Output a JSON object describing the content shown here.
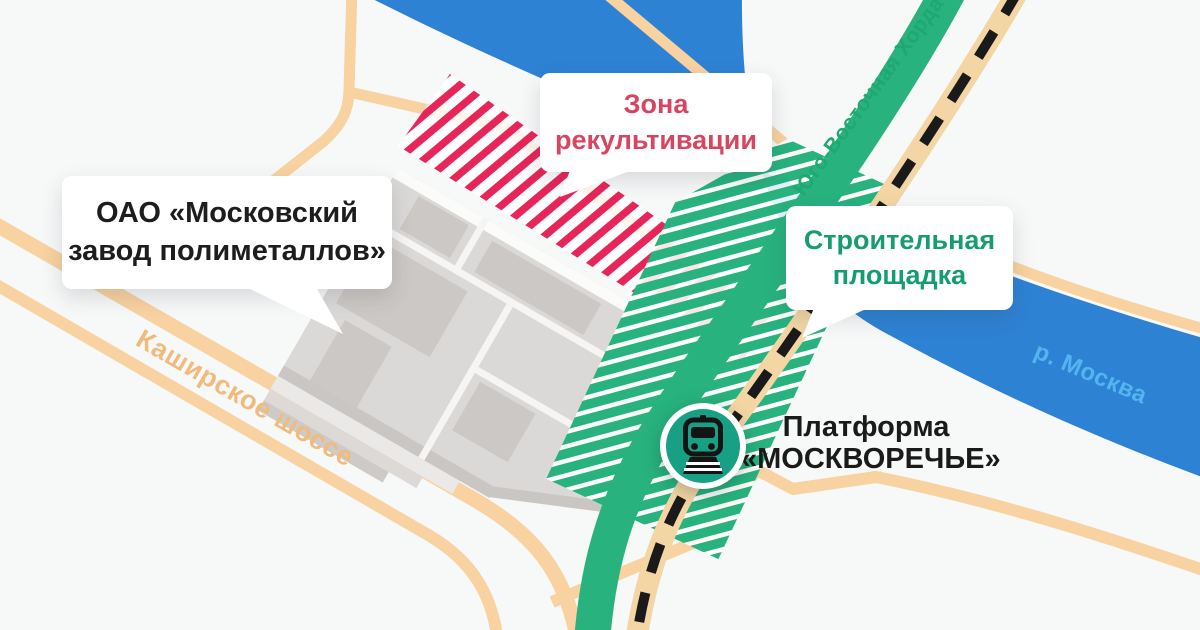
{
  "map": {
    "callouts": {
      "factory": {
        "line1": "ОАО «Московский",
        "line2": "завод полиметаллов»"
      },
      "recultivation_zone": {
        "line1": "Зона",
        "line2": "рекультивации"
      },
      "construction_site": {
        "line1": "Строительная",
        "line2": "площадка"
      }
    },
    "station": {
      "line1": "Платформа",
      "line2": "«МОСКВОРЕЧЬЕ»",
      "icon": "train-icon"
    },
    "roads": {
      "kashirskoye": "Каширское шоссе",
      "chord": "Юго-Восточная Хорда",
      "river": "р. Москва"
    },
    "colors": {
      "background": "#f7f8f8",
      "river": "#2e82d4",
      "river_label": "#53b4ee",
      "road_orange": "#f8d2a0",
      "road_orange_label": "#f0bb7c",
      "chord_green": "#27b27e",
      "chord_label": "#1fa871",
      "construction_text": "#169c71",
      "recultivation_stripe": "#e82558",
      "recultivation_text": "#d84560",
      "railway_tan": "#f3d6a4",
      "railway_black": "#1a1a1a",
      "factory_gray": "#dbd9d7",
      "factory_block": "#ccc8c5",
      "platform_text": "#1a1a1a",
      "bubble_text": "#1d1d1d",
      "train_badge": "#17a084"
    }
  }
}
